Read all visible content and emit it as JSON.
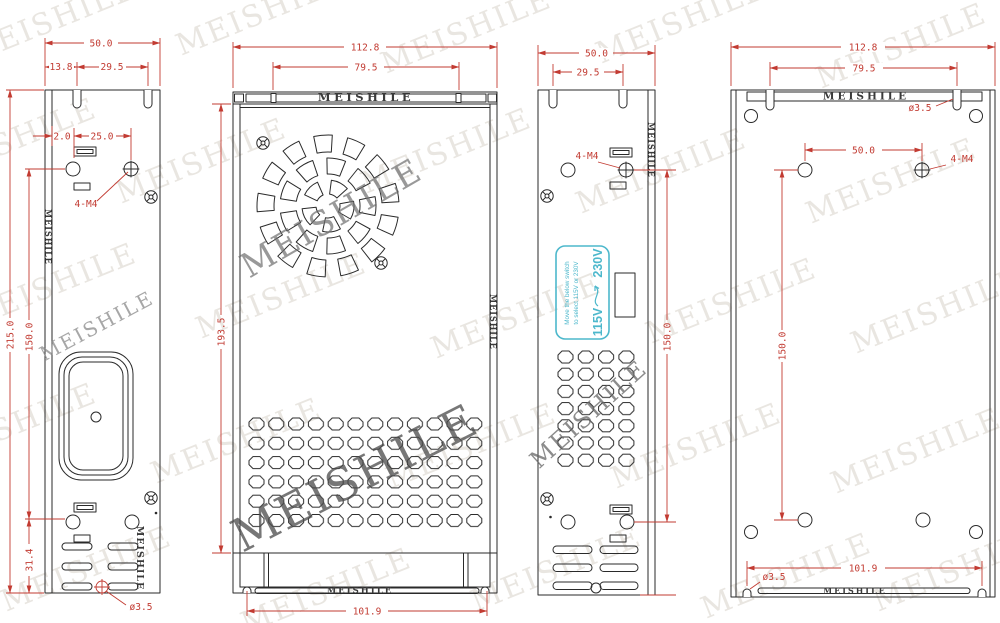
{
  "watermark": {
    "text": "MEISHILE"
  },
  "colors": {
    "dimension": "#c23b32",
    "label": "#4db8cc",
    "line": "#2a2a2a"
  },
  "views": {
    "left_side_view": {
      "dim_width": "50.0",
      "dim_notch_offset": "13.8",
      "dim_notch_span": "29.5",
      "dim_slot_edge": "2.0",
      "dim_hole_pitch": "25.0",
      "dim_height": "215.0",
      "dim_hole_height": "150.0",
      "dim_bottom_offset": "31.4",
      "callout_mount_holes": "4-M4",
      "callout_corner_hole": "ø3.5",
      "brand_fold": "MEISHILE",
      "brand_bottom": "MEISHILE"
    },
    "front_view": {
      "dim_width": "112.8",
      "dim_lid_span": "79.5",
      "dim_height": "193.5",
      "dim_base_width": "101.9",
      "brand_top": "MEISHILE",
      "brand_bottom": "MEISHILE",
      "brand_side": "MEISHILE"
    },
    "right_side_view": {
      "dim_width": "50.0",
      "dim_notch_span": "29.5",
      "dim_hole_height": "150.0",
      "callout_mount_holes": "4-M4",
      "brand_fold": "MEISHILE",
      "voltage_label": {
        "line1": "Move the below switch",
        "line2": "to select 115V or 230V",
        "low": "115V",
        "high": "230V"
      }
    },
    "back_view": {
      "dim_width": "112.8",
      "dim_lid_span": "79.5",
      "dim_hole_pitch": "50.0",
      "dim_hole_height": "150.0",
      "dim_base_width": "101.9",
      "callout_top_notch": "ø3.5",
      "callout_mount_holes": "4-M4",
      "callout_bottom_notch": "ø3.5",
      "brand_top": "MEISHILE",
      "brand_bottom": "MEISHILE"
    }
  }
}
